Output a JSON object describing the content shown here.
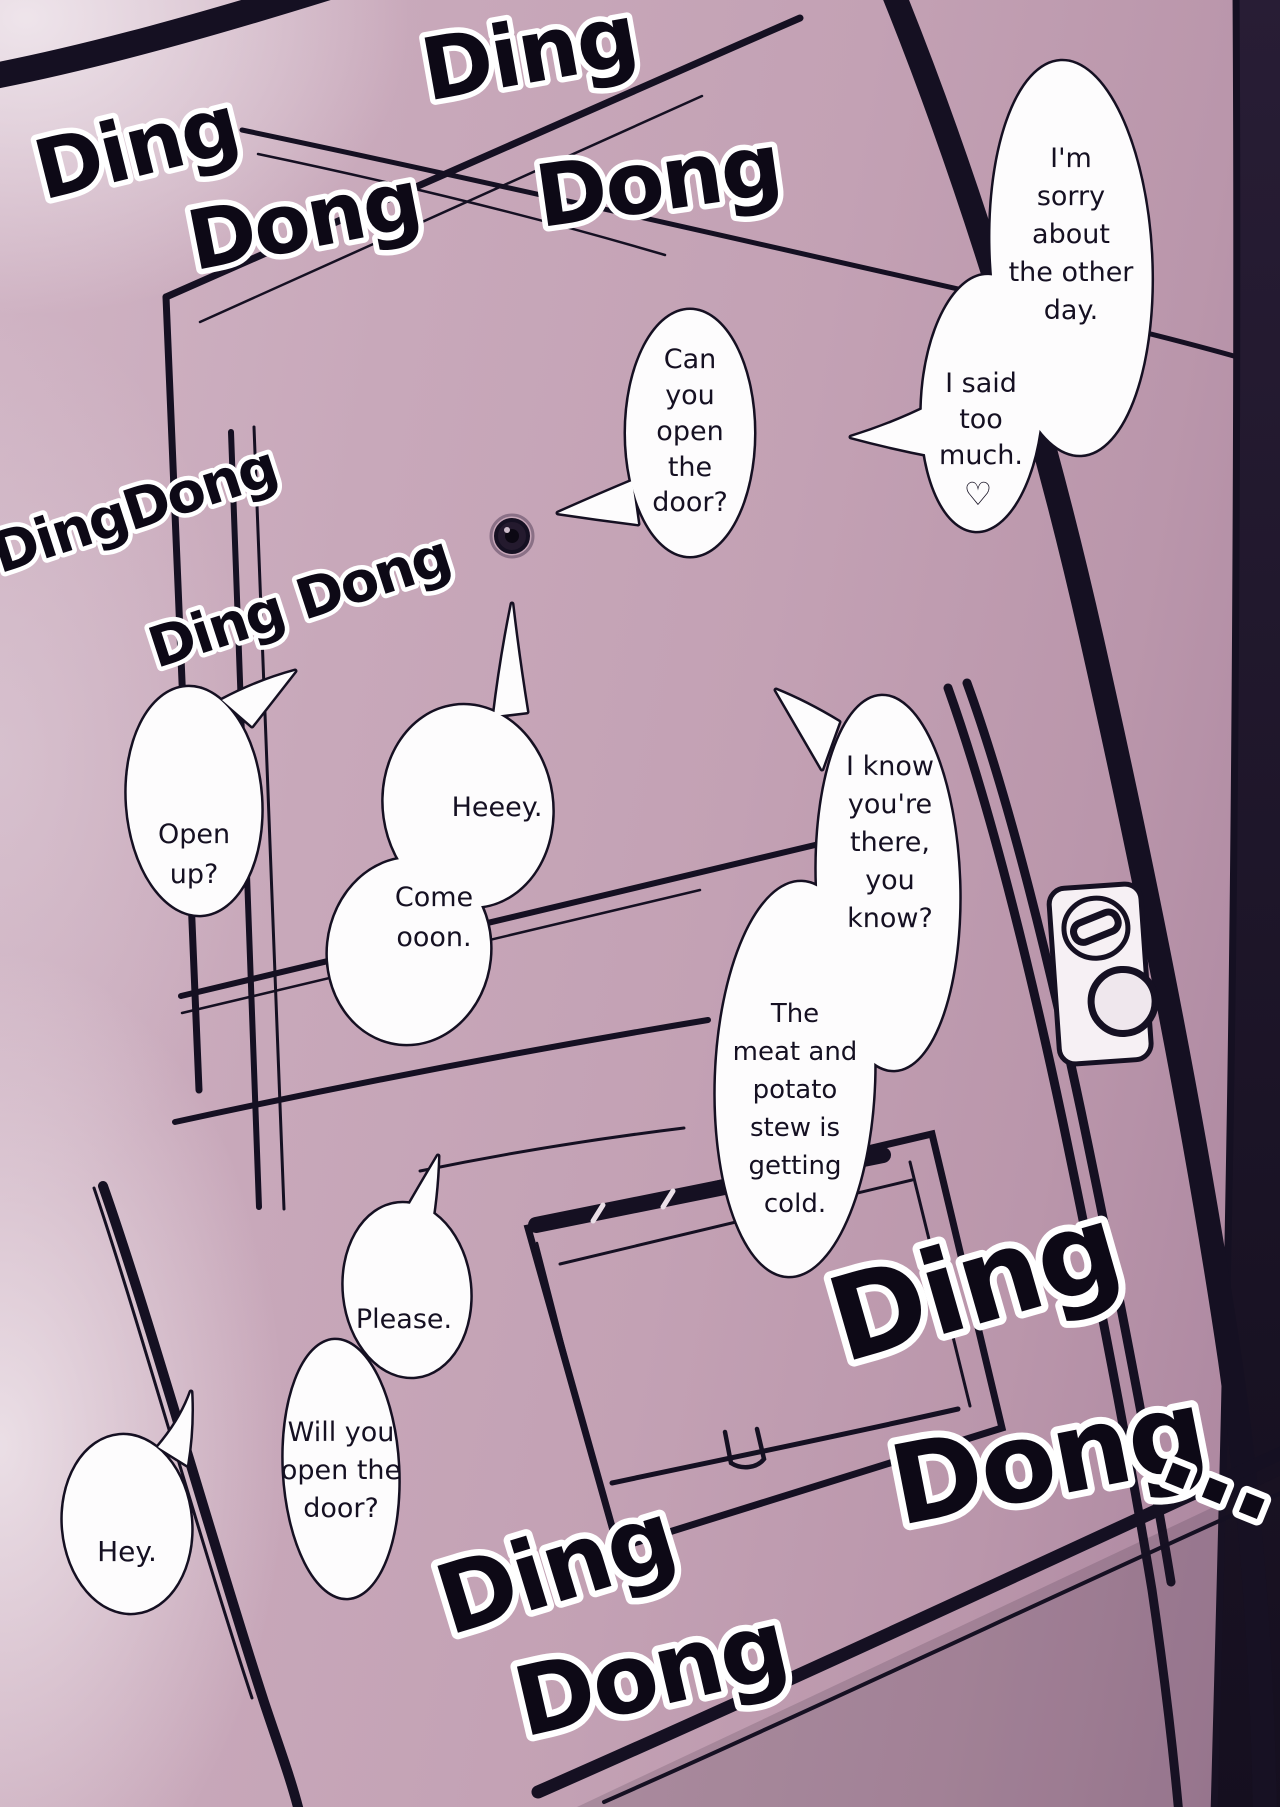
{
  "page": {
    "title": "manga-door-page",
    "width": 1280,
    "height": 1807
  },
  "colors": {
    "background": "#c6a5b8",
    "ink": "#151022",
    "bubble_fill": "#fdfcfd",
    "sfx_fill": "#0d0916",
    "sfx_outline": "#ffffff",
    "edge_shadow": "#150f20"
  },
  "sfx": [
    {
      "name": "doorbell-sfx-top-left-1",
      "text": "Ding"
    },
    {
      "name": "doorbell-sfx-top-left-2",
      "text": "Dong"
    },
    {
      "name": "doorbell-sfx-top-center-1",
      "text": "Ding"
    },
    {
      "name": "doorbell-sfx-top-center-2",
      "text": "Dong"
    },
    {
      "name": "doorbell-sfx-mid-left-1",
      "text": "DingDong"
    },
    {
      "name": "doorbell-sfx-mid-left-2",
      "text": "Ding Dong"
    },
    {
      "name": "doorbell-sfx-bottom-right-1",
      "text": "Ding"
    },
    {
      "name": "doorbell-sfx-bottom-right-2",
      "text": "Dong"
    },
    {
      "name": "doorbell-sfx-bottom-right-dots",
      "text": "..."
    },
    {
      "name": "doorbell-sfx-bottom-center-1",
      "text": "Ding"
    },
    {
      "name": "doorbell-sfx-bottom-center-2",
      "text": "Dong"
    }
  ],
  "speech": {
    "bubbles": [
      {
        "name": "sorry",
        "lines": [
          "I'm",
          "sorry",
          "about",
          "the other",
          "day."
        ]
      },
      {
        "name": "said-too-much",
        "lines": [
          "I said",
          "too",
          "much.",
          "♡"
        ]
      },
      {
        "name": "can-you-open",
        "lines": [
          "Can",
          "you",
          "open",
          "the",
          "door?"
        ]
      },
      {
        "name": "open-up",
        "lines": [
          "Open",
          "up?"
        ]
      },
      {
        "name": "heeey",
        "lines": [
          "Heeey."
        ]
      },
      {
        "name": "come-ooon",
        "lines": [
          "Come",
          "ooon."
        ]
      },
      {
        "name": "i-know-youre-there",
        "lines": [
          "I know",
          "you're",
          "there,",
          "you",
          "know?"
        ]
      },
      {
        "name": "stew-getting-cold",
        "lines": [
          "The",
          "meat and",
          "potato",
          "stew is",
          "getting",
          "cold."
        ]
      },
      {
        "name": "please",
        "lines": [
          "Please."
        ]
      },
      {
        "name": "will-you-open",
        "lines": [
          "Will you",
          "open the",
          "door?"
        ]
      },
      {
        "name": "hey",
        "lines": [
          "Hey."
        ]
      }
    ]
  },
  "door_parts": [
    "door-frame",
    "door-panel",
    "peephole",
    "deadbolt-plate",
    "thumbturn",
    "doorknob",
    "mail-slot-panel",
    "mail-slot",
    "mail-flap-handle"
  ]
}
